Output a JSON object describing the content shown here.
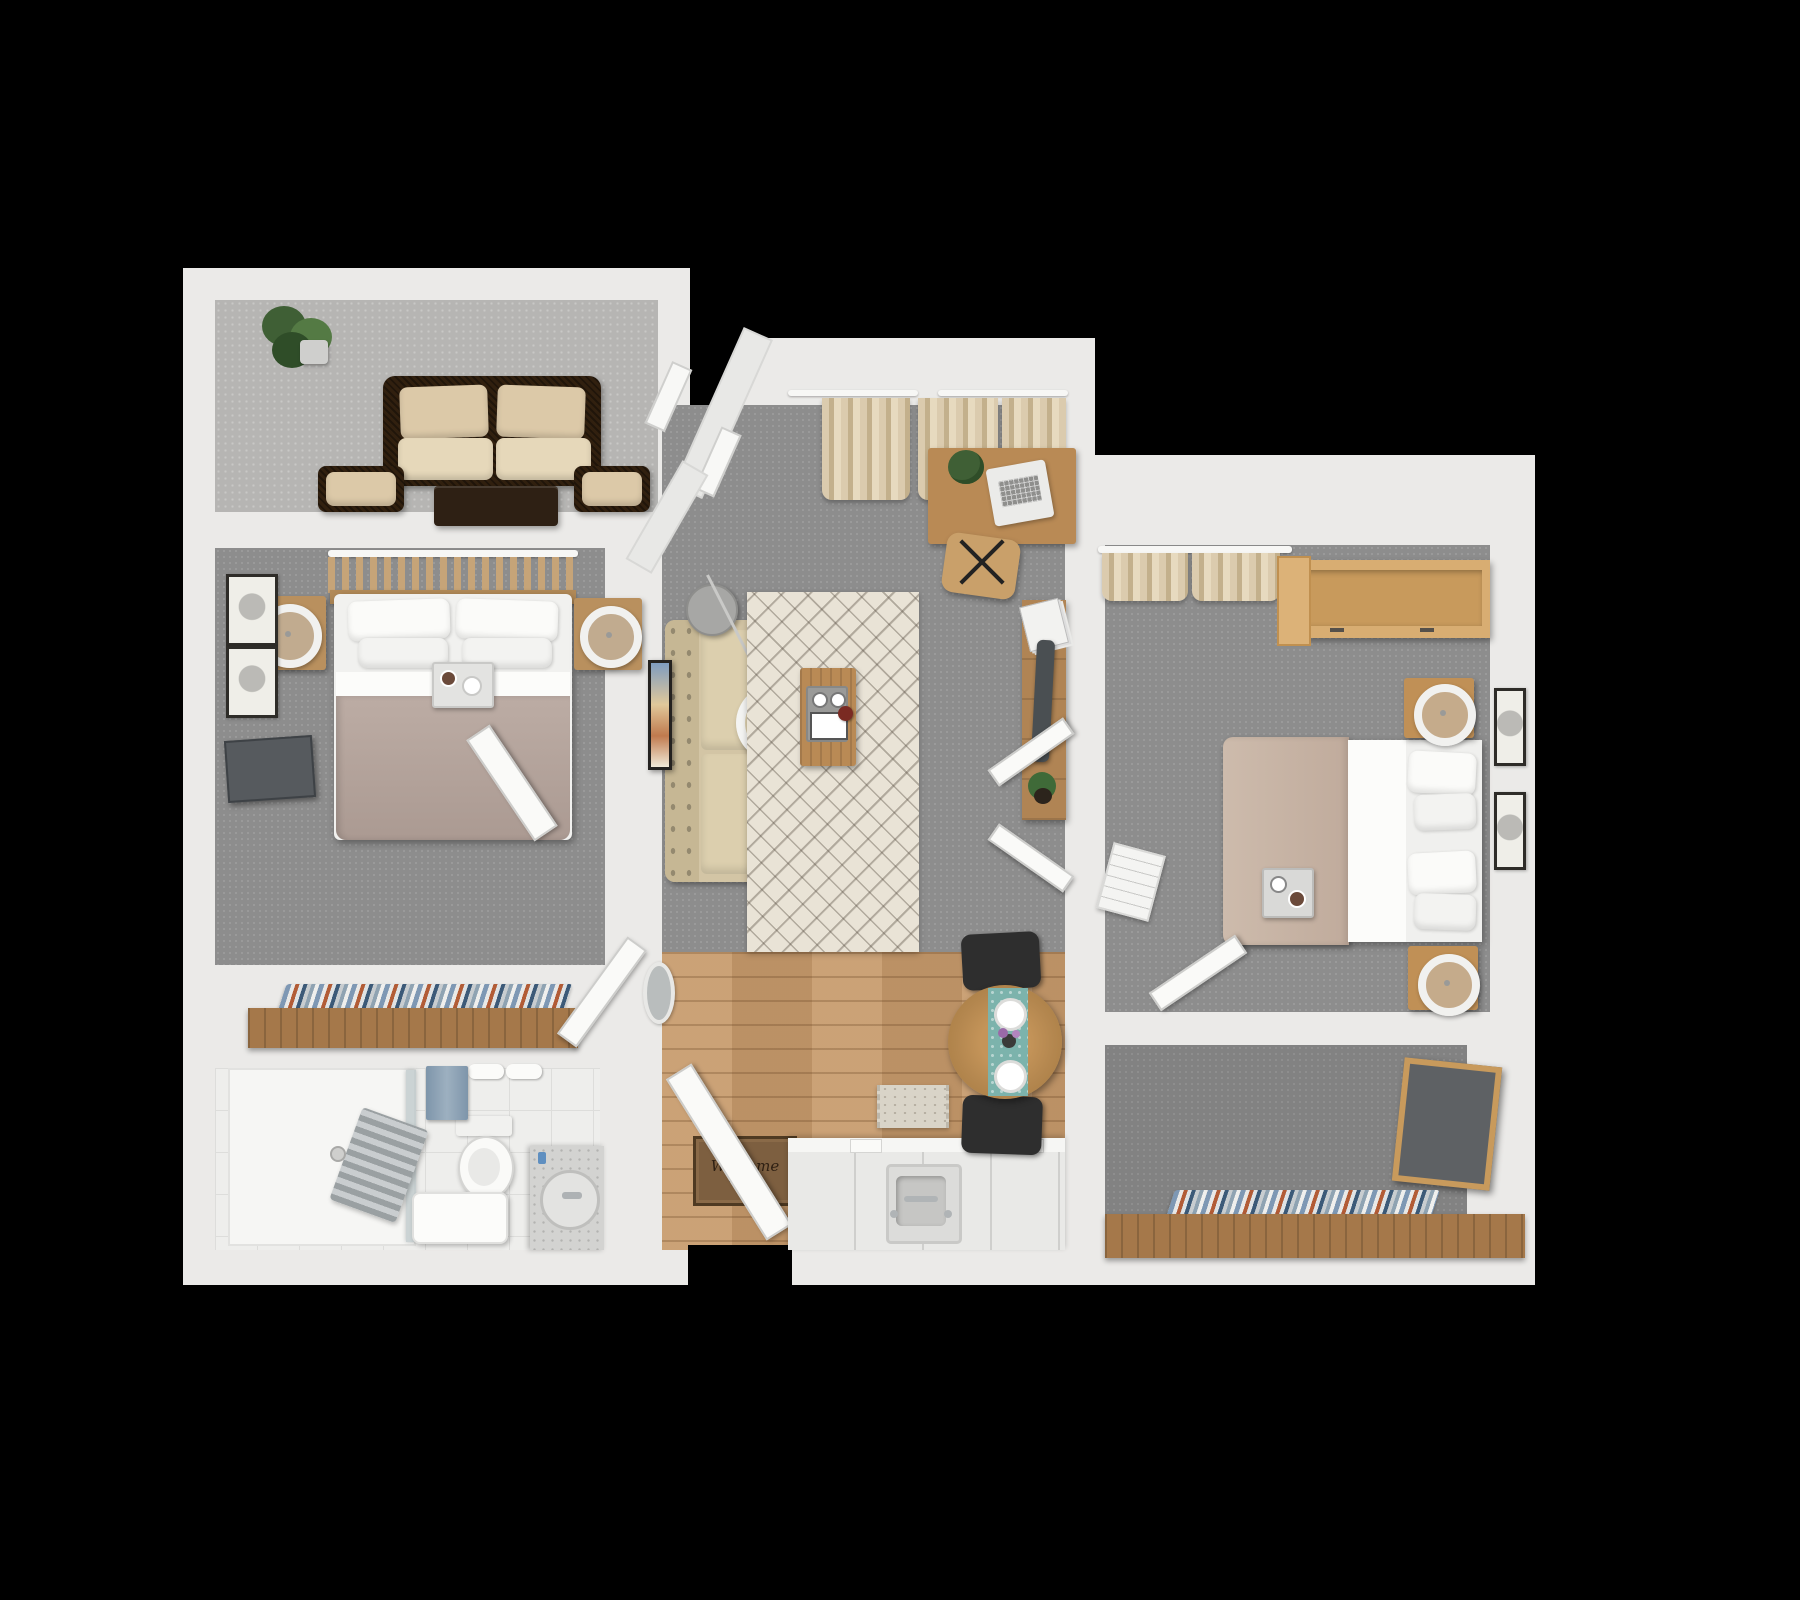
{
  "scene": {
    "type": "3d-floor-plan-render",
    "description": "Top-down 3D rendering of a two-bedroom apartment floor plan on a black background",
    "background_color": "#000000",
    "wall_color": "#ebeae8",
    "floor_colors": {
      "carpet_gray": "#8d8d8d",
      "sunroom_gray": "#b6b5b3",
      "bathroom_tile": "#eeeeec",
      "kitchen_wood": "#c79a6b",
      "dressing_carpet": "#828282"
    },
    "accent_colors": {
      "wood_furniture": "#b98a55",
      "dark_wicker": "#31200f",
      "beige_cushion": "#dcc9a8",
      "duvet_mauve": "#b2a29a",
      "duvet_beige": "#c5b2a4",
      "teal_runner": "#7cb3ac",
      "clothes_blue": "#3c5a78",
      "clothes_rust": "#b25c36",
      "towel_blue": "#7e95aa",
      "mat_brown": "#7d5f40"
    }
  },
  "welcome_mat": {
    "line1": "Welcome",
    "line2": "HOME"
  },
  "rooms": {
    "sunroom": {
      "id": "sunroom",
      "furniture": [
        "potted-plant",
        "wicker-loveseat",
        "accent-chair-left",
        "accent-chair-right",
        "coffee-table"
      ]
    },
    "bedroom_left": {
      "id": "bedroom-left",
      "furniture": [
        "slat-canopy",
        "double-bed",
        "pillows",
        "breakfast-tray",
        "nightstand-left",
        "ring-lamp",
        "nightstand-right",
        "ring-lamp",
        "wall-art",
        "wall-art",
        "wall-tv",
        "door"
      ]
    },
    "closet_left": {
      "id": "closet-left",
      "furniture": [
        "closet-unit",
        "hanging-clothes"
      ]
    },
    "bathroom": {
      "id": "bathroom",
      "furniture": [
        "walk-in-shower",
        "glass-screen",
        "towel-radiator",
        "toilet",
        "shower-bench",
        "rolled-towels",
        "hand-towel",
        "vanity",
        "round-sink",
        "faucet"
      ]
    },
    "living_room": {
      "id": "living-room",
      "furniture": [
        "bay-window",
        "curtains",
        "desk",
        "laptop",
        "desk-plant",
        "office-chair",
        "sofa",
        "wall-art",
        "arc-floor-lamp",
        "area-rug",
        "coffee-table",
        "serving-tray",
        "red-coaster",
        "console-shelf",
        "magazines",
        "hanging-garment",
        "shelf-plant",
        "closet-doors"
      ]
    },
    "kitchen_entry": {
      "id": "kitchen-entry",
      "furniture": [
        "entry-door",
        "welcome-mat",
        "oval-mirror",
        "interior-door",
        "runner-rug",
        "kitchen-counter",
        "sink",
        "faucet",
        "cutting-boards"
      ]
    },
    "dining": {
      "id": "dining-nook",
      "furniture": [
        "round-table",
        "table-runner",
        "plate",
        "plate",
        "flower-vase",
        "dining-chair-top",
        "dining-chair-bottom"
      ]
    },
    "bedroom_right": {
      "id": "bedroom-right",
      "furniture": [
        "curtains",
        "open-wardrobe",
        "double-bed",
        "pillows",
        "breakfast-tray",
        "nightstand-top",
        "ring-lamp",
        "nightstand-bottom",
        "ring-lamp",
        "wall-art",
        "wall-art",
        "door",
        "floor-magazine"
      ]
    },
    "dressing_room": {
      "id": "dressing-room",
      "furniture": [
        "closet-unit",
        "hanging-clothes",
        "leaning-mirror"
      ]
    }
  }
}
